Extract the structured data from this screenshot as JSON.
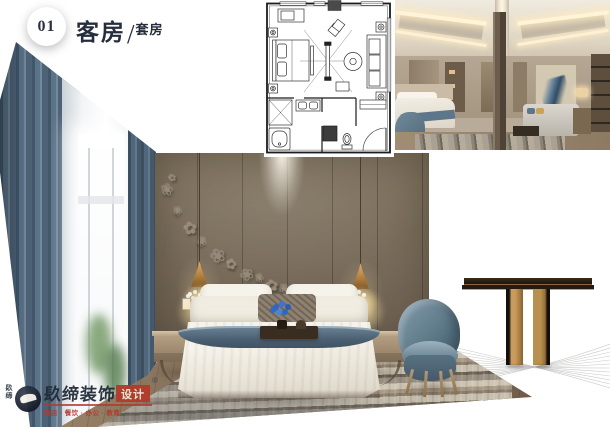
{
  "header": {
    "index_number": "01",
    "title": "客房",
    "separator": "/",
    "subtitle": "套房"
  },
  "icons": {
    "flower": "❀",
    "flower_alt": "✿"
  },
  "watermark": {
    "side_text": "镹缔",
    "brand": "镹缔装饰",
    "brand_box": "设计",
    "registered": "®",
    "tagline": "酒店 · 餐饮 · 办公 · 教育"
  },
  "colors": {
    "accent_navy": "#262d3c",
    "seal_red": "#b23a2b",
    "curtain_blue": "#5b7389",
    "wall_taupe": "#7b6e5f",
    "chair_blue": "#5f7a8c",
    "brass": "#c89c5e",
    "flower_blue": "#2f66c4"
  }
}
